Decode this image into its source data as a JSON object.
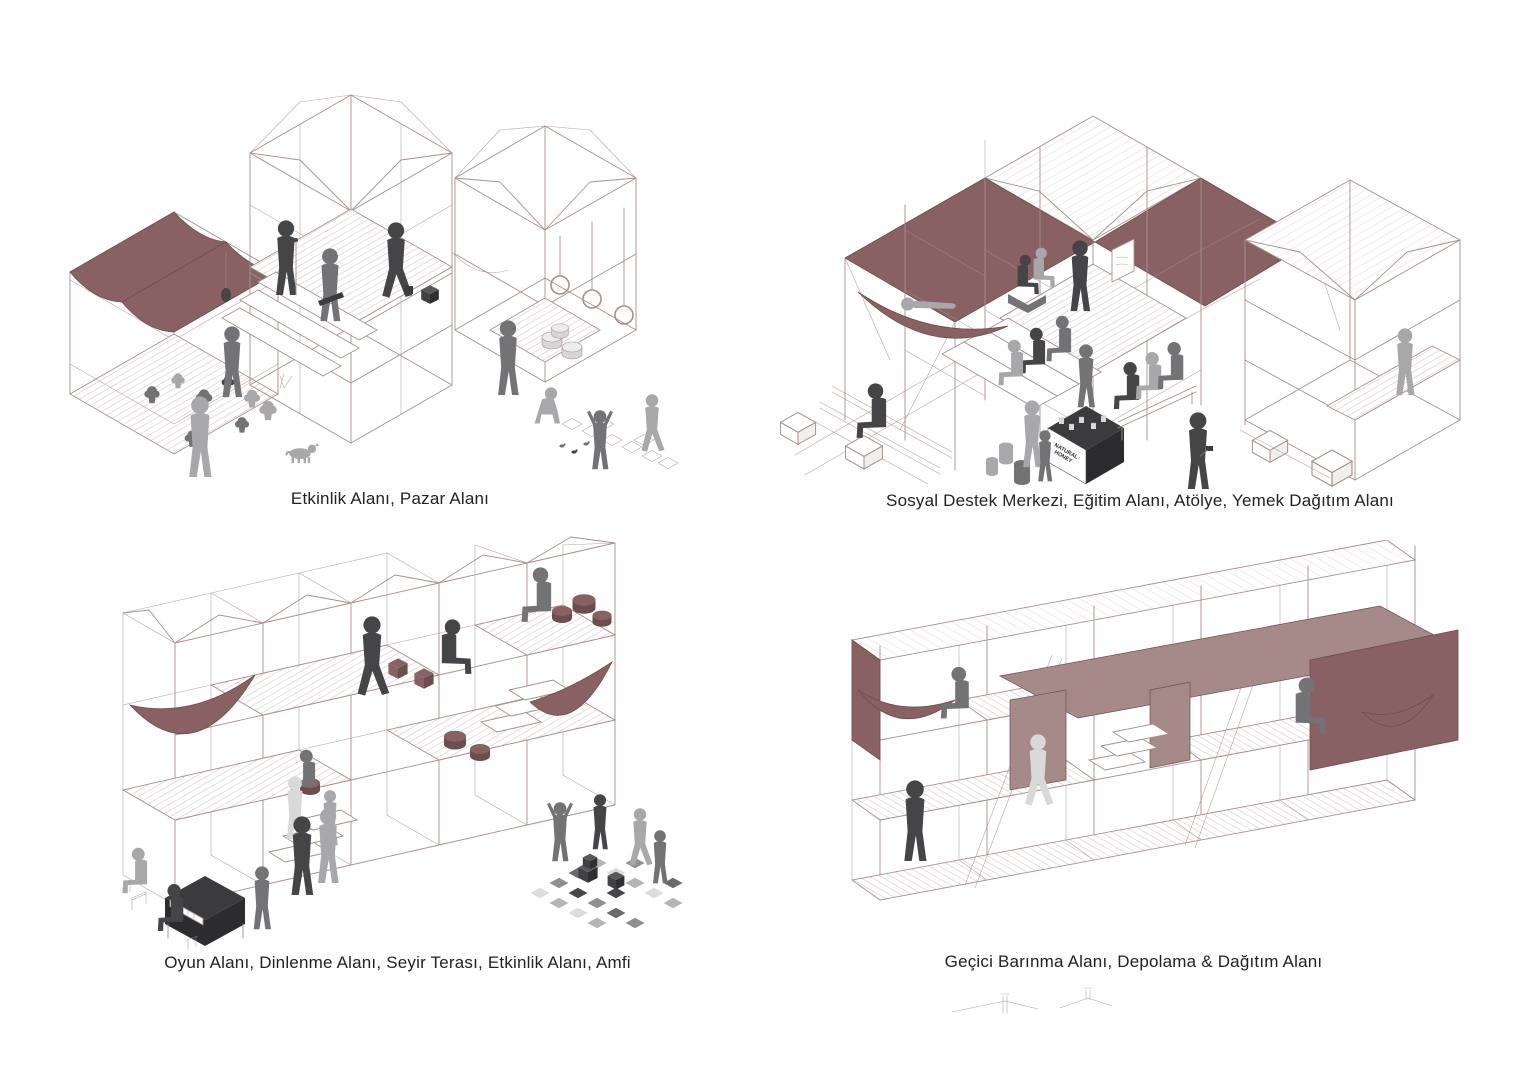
{
  "palette": {
    "paper": "#ffffff",
    "ink": "#232220",
    "line": "#a5918d",
    "maroon": "#8a6163",
    "maroondark": "#6f4c4e",
    "maroonlight": "#a68a87",
    "pdark": "#454547",
    "pmid": "#737376",
    "plight": "#a8a8ab"
  },
  "panels": [
    {
      "id": "etkinlik",
      "caption": "Etkinlik Alanı, Pazar Alanı"
    },
    {
      "id": "sosyal",
      "caption": "Sosyal Destek Merkezi, Eğitim Alanı, Atölye, Yemek Dağıtım Alanı",
      "stall_sign": [
        "NATURAL",
        "HONEY"
      ]
    },
    {
      "id": "oyun",
      "caption": "Oyun Alanı, Dinlenme Alanı, Seyir Terası, Etkinlik Alanı, Amfi"
    },
    {
      "id": "gecici",
      "caption": "Geçici Barınma Alanı, Depolama & Dağıtım Alanı"
    }
  ]
}
